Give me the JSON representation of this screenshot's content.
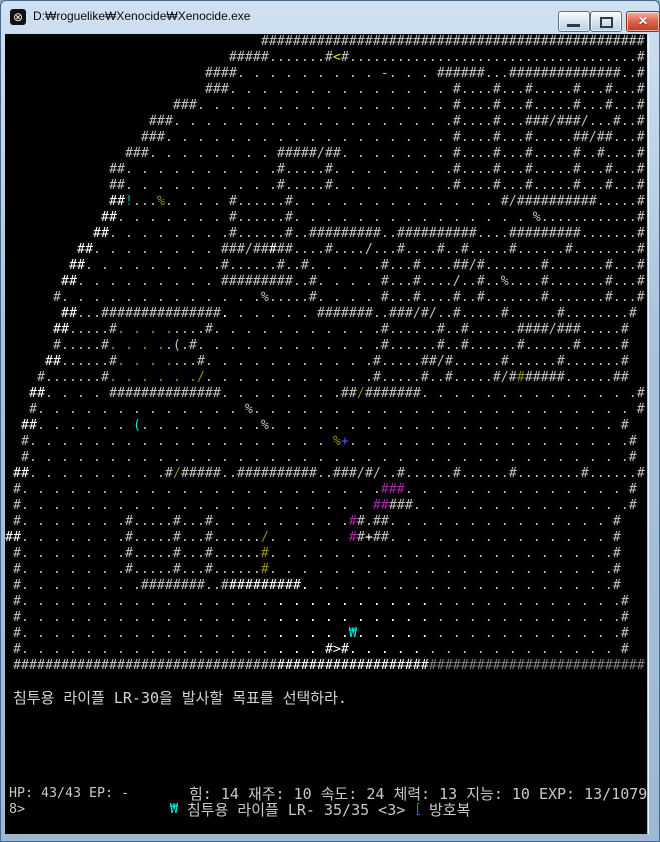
{
  "window": {
    "title": "D:₩roguelike₩Xenocide₩Xenocide.exe",
    "icon_glyph": "⊗",
    "close_glyph": "✕"
  },
  "map": {
    "default_color": "#c0c0c0",
    "rows": [
      "                                ################################################",
      "                            #####.......#<#....................................#",
      "                         ####. . . . . . . . . -. . . ######...##############..#",
      "                         ###. . . . . . . . . . . . . . #....#...#.....#...#...#...#",
      "                     ###. . . . . . . . . . . . . . . . #....#...#.....#...#...#...#",
      "                  ###. . . . . . . . . . . . . . . . . .#....#...###/###/...#..#",
      "                 ###. . . . . . . . . . . . . . . . . . #....#...#.....##/##...#",
      "               ###. . . . . . . . #####/##. . . . . . . #....#...#.....#..#....#",
      "             ##. . . . . . . . . .#.....#. . . . . . . .#....#...#.....#...#...#...#",
      "             ##. . . . . . . . . .#.....#. . . . . . . .#....#...#.....#...#...#...#",
      "             ##!...%. . . . #......#. . . . . . . . . . . . . #/##########.....#",
      "            ##. . . . . . . #......#. . . . . . . . . . . . . . . %............#",
      "           ##. . . . . . . .#......#..#########..##########....#########.......#",
      "         ##. . . . . . . . ###/#####....#..../...#....#..#.....#......#........#",
      "        ##. . . . . . . . .#......#..#. . . . .#...#....##/#.......#.......#...#",
      "       ##. . . . . . . . . #########..#. . . . #...#..../..#..%....#.......#...#",
      "      #. . . . . . . . . . . . .%.....#. . . . #...#....#..#.......#.......#...#",
      "       ##...###############. . . . . . #######..###/#/..#.....#......#........#",
      "      ##.....#. . . .....#. . . . . . . . . . .#......#..#......####/###.....#",
      "      #.....#. . . ..(.#. . . . . . . . . . . .#......#..#......#......#.....#",
      "     ##......#. . . ....#. . . . . . . . . . .#.....##/#......#......#.......#",
      "    #.......#. . . . . ./. . . . . . . . . . .#.....#..#.....#/#######......##",
      "   ##. . . . ##############. . . . . . . .##/#######. . . . . . . . . . . . . .#",
      "   #. . . . . . . . . . . . . %. . . . . . . . . . . . . . . . . . . . . . . . #",
      "  ##. . . . . . (. . . . . . . .%. . . . . . . . . . . . . . . . . . . . . . #",
      "  #. . . . . . . . . . . . . . . . . . . %+. . . . . . . . . . . . . . . . . .#",
      "  #. . . . . . . . . . . . . . . . . . . . . . . . . . . . . . . . . . . . . .#",
      " ##. . . . . . . . .#/#####..##########..###/#/..#......#......#........#......#",
      " #. . . . . . . . . . . . . . . . . . . . . . .###. . . . . . . . . . . . . . #",
      " #. . . . . . . . . . . . . . . . . . . . . . #####. . . . . . . . . . . . . .#",
      " #. . . . . . .#.....#...#. . . . . . . . .##.##. . . . . . . . . . . . . . #",
      "##. . . . . . .#.....#...#....../. . . . . ##+##. . . . . . . . . . . . . . #",
      " #. . . . . . .#.....#...#......#. . . . . . . . . . . . . . . . . . . . . .#",
      " #. . . . . . .#.....#...#......#. . . . . . . . . . . . . . . . . . . . . .#",
      " #. . . . . . . .########..##########. . . . . . . . . . . . . . . . . . . .#",
      " #. . . . . . . . . . . . . . . . . . . . . . . . . . . . . . . . . . . . . .#",
      " #. . . . . . . . . . . . . . . . . . . . . . . . . . . . . . . . . . . . . .#",
      " #. . . . . . . . . . . . . . . . . . . . .₩. . . . . . . . . . . . . . . . .#",
      " #. . . . . . . . . . . . . . . . . . . #>#. . . . . . . . . . . . . . . . . #",
      " ###############################################################################"
    ],
    "overrides": [
      [
        1,
        41,
        1,
        "#e8e800"
      ],
      [
        10,
        13,
        2,
        "#ffffff"
      ],
      [
        10,
        15,
        1,
        "#00a5a5"
      ],
      [
        10,
        19,
        1,
        "#8f8f00"
      ],
      [
        11,
        12,
        2,
        "#ffffff"
      ],
      [
        12,
        11,
        2,
        "#ffffff"
      ],
      [
        13,
        9,
        2,
        "#ffffff"
      ],
      [
        13,
        33,
        1,
        "#ffffff"
      ],
      [
        14,
        8,
        2,
        "#ffffff"
      ],
      [
        15,
        7,
        2,
        "#ffffff"
      ],
      [
        17,
        7,
        2,
        "#ffffff"
      ],
      [
        17,
        27,
        1,
        "#ffffff"
      ],
      [
        18,
        6,
        2,
        "#ffffff"
      ],
      [
        18,
        14,
        7,
        "#8f8f00"
      ],
      [
        19,
        13,
        7,
        "#8f8f00"
      ],
      [
        20,
        5,
        2,
        "#ffffff"
      ],
      [
        20,
        14,
        7,
        "#8f8f00"
      ],
      [
        21,
        13,
        12,
        "#8f8f00"
      ],
      [
        21,
        64,
        1,
        "#8f8f00"
      ],
      [
        22,
        3,
        2,
        "#ffffff"
      ],
      [
        22,
        44,
        1,
        "#8f8f00"
      ],
      [
        24,
        2,
        2,
        "#ffffff"
      ],
      [
        24,
        16,
        1,
        "#00e8e8"
      ],
      [
        25,
        41,
        1,
        "#8f8f00"
      ],
      [
        25,
        42,
        1,
        "#4455ff"
      ],
      [
        27,
        1,
        2,
        "#ffffff"
      ],
      [
        27,
        21,
        1,
        "#8f8f00"
      ],
      [
        28,
        47,
        3,
        "#aa22aa"
      ],
      [
        29,
        46,
        2,
        "#aa22aa"
      ],
      [
        30,
        43,
        1,
        "#aa22aa"
      ],
      [
        31,
        0,
        2,
        "#ffffff"
      ],
      [
        31,
        32,
        1,
        "#8f8f00"
      ],
      [
        31,
        43,
        1,
        "#aa22aa"
      ],
      [
        31,
        45,
        1,
        "#ffffff"
      ],
      [
        32,
        32,
        1,
        "#8f8f00"
      ],
      [
        33,
        32,
        1,
        "#8f8f00"
      ],
      [
        34,
        28,
        10,
        "#ffffff"
      ],
      [
        35,
        33,
        20,
        "#ffffff"
      ],
      [
        36,
        33,
        20,
        "#ffffff"
      ],
      [
        37,
        33,
        10,
        "#ffffff"
      ],
      [
        37,
        43,
        1,
        "#00e8e8"
      ],
      [
        37,
        44,
        9,
        "#ffffff"
      ],
      [
        38,
        33,
        20,
        "#ffffff"
      ],
      [
        39,
        34,
        19,
        "#ffffff"
      ],
      [
        39,
        53,
        27,
        "#808080"
      ]
    ]
  },
  "message": {
    "text": "침투용 라이플 LR-30을 발사할 목표를 선택하라."
  },
  "statusbar": {
    "hp_ep": "HP: 43/43 EP: -",
    "stats": "힘: 14 재주: 10 속도: 24 체력: 13 지능: 10 EXP: 13/1079340 <",
    "wrap": "8>",
    "weapon_icon": "₩",
    "weapon_text": "침투용 라이플 LR- 35/35 <3>",
    "armor_icon": "[",
    "armor_text": "방호복",
    "location": "도시 - 북서부 구역"
  }
}
